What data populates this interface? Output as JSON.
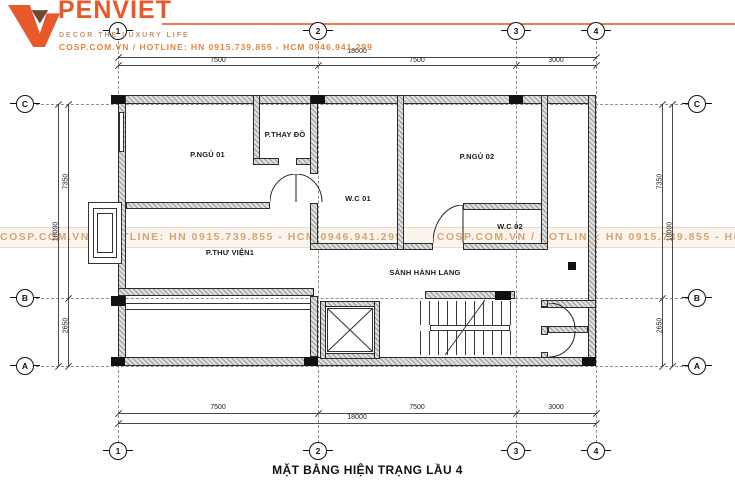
{
  "header": {
    "brand": "PENVIET",
    "tagline": "DECOR THE LUXURY LIFE",
    "contact": "COSP.COM.VN / HOTLINE: HN 0915.739.855 - HCM 0946.941.299",
    "brand_color": "#e8582a",
    "accent_line_color": "#ef7b4a"
  },
  "watermark": {
    "text": "COSP.COM.VN / HOTLINE: HN 0915.739.855 - HCM 0946.941.299",
    "color": "#d2a678"
  },
  "plan": {
    "grid": {
      "cols": [
        "1",
        "2",
        "3",
        "4"
      ],
      "rows": [
        "C",
        "B",
        "A"
      ]
    },
    "dims": {
      "top_total": "18000",
      "top_segs": [
        "7500",
        "7500",
        "3000"
      ],
      "bottom_total": "18000",
      "bottom_segs": [
        "7500",
        "7500",
        "3000"
      ],
      "left_total": "10000",
      "left_segs": [
        "7350",
        "2650"
      ],
      "right_total": "10000",
      "right_segs": [
        "7350",
        "2650"
      ]
    },
    "rooms": {
      "bedroom1": "P.NGỦ 01",
      "dressing": "P.THAY ĐỒ",
      "wc1": "W.C 01",
      "bedroom2": "P.NGỦ 02",
      "wc2": "W.C 02",
      "library": "P.THƯ VIỆN1",
      "hallway": "SẢNH HÀNH LANG"
    }
  },
  "caption": "MẶT BẰNG HIỆN TRẠNG LẦU 4"
}
